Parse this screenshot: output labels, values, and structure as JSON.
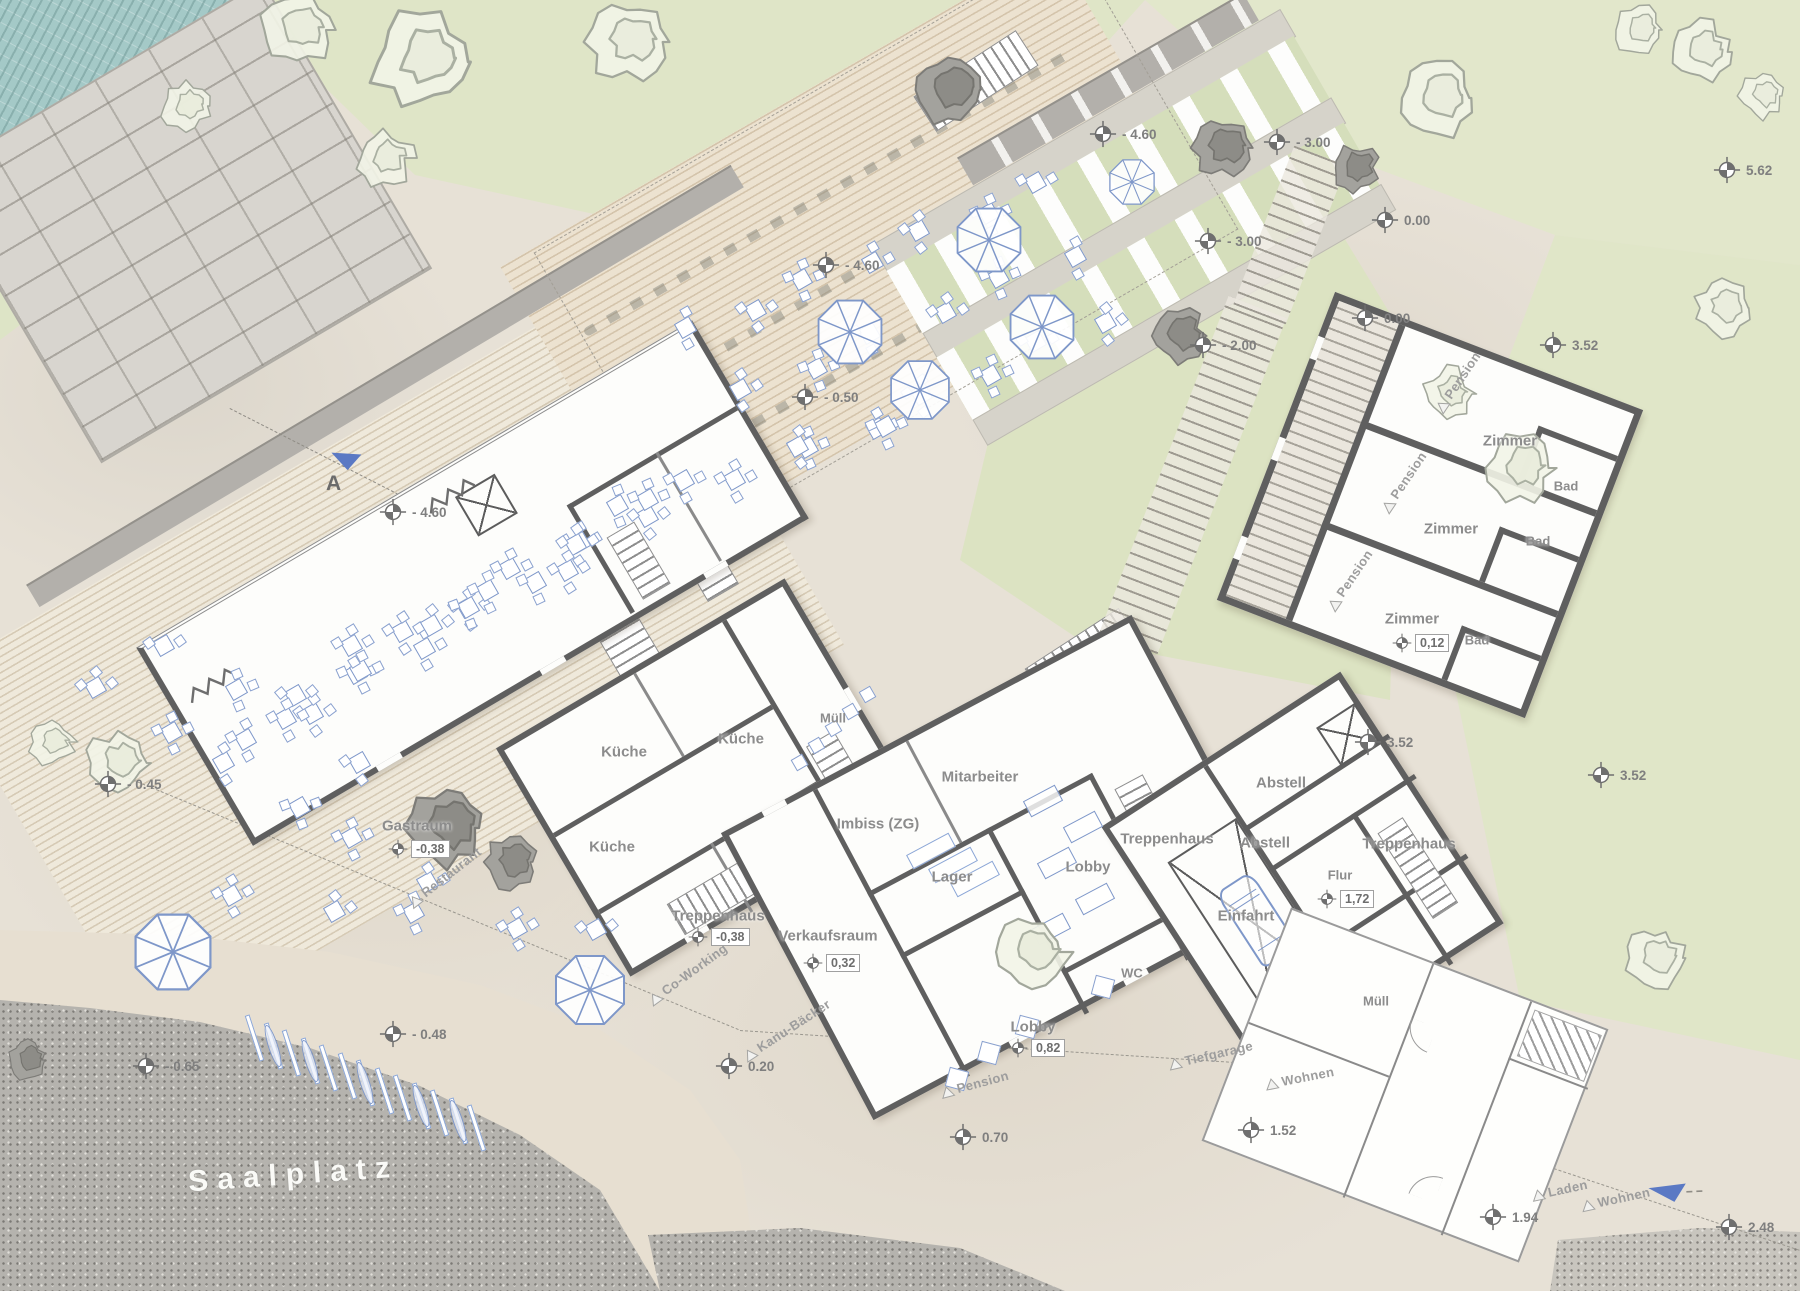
{
  "plan": {
    "place_label": "Saalplatz",
    "section_label": "A",
    "palette": {
      "furniture_blue": "#7e97c9",
      "wall_gray": "#5f5f5f",
      "water_teal": "#a4c9c7",
      "lawn_green": "#dfe5c7",
      "granite_gray": "#b5b3ae"
    },
    "rooms": [
      {
        "label": "Gastraum",
        "x": 417,
        "y": 826,
        "value": "-0,38",
        "mx": 398,
        "my": 849
      },
      {
        "label": "Küche",
        "x": 624,
        "y": 752
      },
      {
        "label": "Küche",
        "x": 741,
        "y": 739
      },
      {
        "label": "Küche",
        "x": 612,
        "y": 847
      },
      {
        "label": "Müll",
        "x": 833,
        "y": 718
      },
      {
        "label": "Treppenhaus",
        "x": 718,
        "y": 916,
        "value": "-0,38",
        "mx": 698,
        "my": 937
      },
      {
        "label": "Verkaufsraum",
        "x": 828,
        "y": 936,
        "value": "0,32",
        "mx": 813,
        "my": 963
      },
      {
        "label": "Imbiss (ZG)",
        "x": 878,
        "y": 824
      },
      {
        "label": "Mitarbeiter",
        "x": 980,
        "y": 777
      },
      {
        "label": "Lager",
        "x": 952,
        "y": 877
      },
      {
        "label": "Lobby",
        "x": 1088,
        "y": 867
      },
      {
        "label": "Treppenhaus",
        "x": 1167,
        "y": 839
      },
      {
        "label": "WC",
        "x": 1132,
        "y": 973
      },
      {
        "label": "Lobby",
        "x": 1033,
        "y": 1027,
        "value": "0,82",
        "mx": 1018,
        "my": 1048
      },
      {
        "label": "Abstell",
        "x": 1281,
        "y": 783
      },
      {
        "label": "Abstell",
        "x": 1265,
        "y": 843
      },
      {
        "label": "Einfahrt",
        "x": 1246,
        "y": 916
      },
      {
        "label": "Flur",
        "x": 1340,
        "y": 875,
        "value": "1,72",
        "mx": 1327,
        "my": 899
      },
      {
        "label": "Müll",
        "x": 1376,
        "y": 1001
      },
      {
        "label": "Treppenhaus",
        "x": 1409,
        "y": 844
      },
      {
        "label": "Zimmer",
        "x": 1510,
        "y": 441
      },
      {
        "label": "Bad",
        "x": 1566,
        "y": 486
      },
      {
        "label": "Zimmer",
        "x": 1451,
        "y": 529
      },
      {
        "label": "Bad",
        "x": 1538,
        "y": 541
      },
      {
        "label": "Zimmer",
        "x": 1412,
        "y": 619,
        "value": "0,12",
        "mx": 1402,
        "my": 643
      },
      {
        "label": "Bad",
        "x": 1477,
        "y": 640
      }
    ],
    "site_markers": [
      {
        "value": "- 4.60",
        "x": 1103,
        "y": 134
      },
      {
        "value": "- 3.00",
        "x": 1277,
        "y": 142
      },
      {
        "value": "0.00",
        "x": 1385,
        "y": 220
      },
      {
        "value": "- 3.00",
        "x": 1208,
        "y": 241
      },
      {
        "value": "- 2.00",
        "x": 1203,
        "y": 345
      },
      {
        "value": "0.00",
        "x": 1365,
        "y": 318
      },
      {
        "value": "3.52",
        "x": 1553,
        "y": 345
      },
      {
        "value": "5.62",
        "x": 1727,
        "y": 170
      },
      {
        "value": "- 4.60",
        "x": 826,
        "y": 265
      },
      {
        "value": "- 0.50",
        "x": 805,
        "y": 397
      },
      {
        "value": "- 4.60",
        "x": 393,
        "y": 512
      },
      {
        "value": "- 0.45",
        "x": 108,
        "y": 784
      },
      {
        "value": "- 0.65",
        "x": 146,
        "y": 1066
      },
      {
        "value": "- 0.48",
        "x": 393,
        "y": 1034
      },
      {
        "value": "0.20",
        "x": 729,
        "y": 1066
      },
      {
        "value": "0.70",
        "x": 963,
        "y": 1137
      },
      {
        "value": "1.52",
        "x": 1251,
        "y": 1130
      },
      {
        "value": "1.94",
        "x": 1493,
        "y": 1217
      },
      {
        "value": "2.48",
        "x": 1729,
        "y": 1227
      },
      {
        "value": "3.52",
        "x": 1368,
        "y": 742
      },
      {
        "value": "3.52",
        "x": 1601,
        "y": 775
      }
    ],
    "path_labels": [
      {
        "text": "Restaurant",
        "x": 445,
        "y": 877,
        "angle": -38
      },
      {
        "text": "Co-Working",
        "x": 688,
        "y": 974,
        "angle": -36
      },
      {
        "text": "Kanu-Bäcker",
        "x": 787,
        "y": 1030,
        "angle": -33
      },
      {
        "text": "Pension",
        "x": 975,
        "y": 1084,
        "angle": -15
      },
      {
        "text": "Tiefgarage",
        "x": 1211,
        "y": 1055,
        "angle": -13
      },
      {
        "text": "Wohnen",
        "x": 1300,
        "y": 1078,
        "angle": -11
      },
      {
        "text": "Laden",
        "x": 1560,
        "y": 1190,
        "angle": -12
      },
      {
        "text": "Wohnen",
        "x": 1616,
        "y": 1199,
        "angle": -12
      },
      {
        "text": "Pension",
        "x": 1458,
        "y": 382,
        "angle": -56
      },
      {
        "text": "Pension",
        "x": 1404,
        "y": 482,
        "angle": -56
      },
      {
        "text": "Pension",
        "x": 1350,
        "y": 580,
        "angle": -56
      }
    ]
  }
}
